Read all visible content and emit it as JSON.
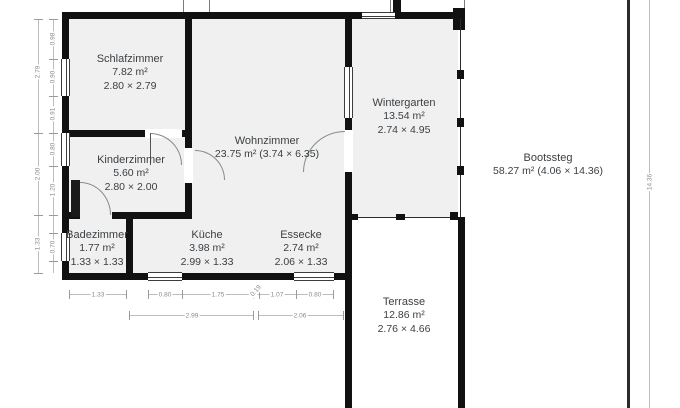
{
  "rooms": {
    "schlafzimmer": {
      "name": "Schlafzimmer",
      "area": "7.82 m²",
      "size": "2.80 × 2.79"
    },
    "kinderzimmer": {
      "name": "Kinderzimmer",
      "area": "5.60 m²",
      "size": "2.80 × 2.00"
    },
    "badezimmer": {
      "name": "Badezimmer",
      "area": "1.77 m²",
      "size": "1.33 × 1.33"
    },
    "wohnzimmer": {
      "name": "Wohnzimmer",
      "area": "23.75 m² (3.74 × 6.35)"
    },
    "kueche": {
      "name": "Küche",
      "area": "3.98 m²",
      "size": "2.99 × 1.33"
    },
    "essecke": {
      "name": "Essecke",
      "area": "2.74 m²",
      "size": "2.06 × 1.33"
    },
    "wintergarten": {
      "name": "Wintergarten",
      "area": "13.54 m²",
      "size": "2.74 × 4.95"
    },
    "bootssteg": {
      "name": "Bootssteg",
      "area": "58.27 m² (4.06 × 14.36)"
    },
    "terrasse": {
      "name": "Terrasse",
      "area": "12.86 m²",
      "size": "2.76 × 4.66"
    }
  },
  "dims": {
    "left_outer": [
      "2.79",
      "2.00",
      "1.33"
    ],
    "left_inner": [
      "0.98",
      "0.90",
      "0.91",
      "0.80",
      "1.20",
      "0.70"
    ],
    "bottom_inner": [
      "1.33",
      "0.80",
      "1.75",
      "0.19",
      "1.07",
      "0.80"
    ],
    "bottom_outer": [
      "2.99",
      "2.06"
    ],
    "right_side": [
      "14.36"
    ]
  },
  "colors": {
    "wall": "#111111",
    "room_fill": "#f0f0f0",
    "dimension": "#8a8a8a",
    "label_text": "#3c4043",
    "background": "#ffffff"
  }
}
